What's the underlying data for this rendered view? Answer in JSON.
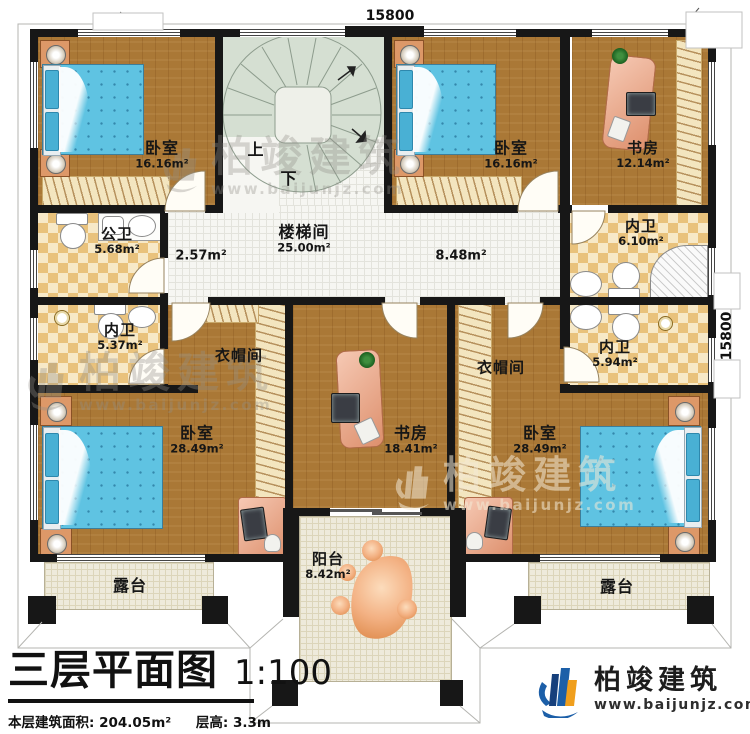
{
  "dimensions": {
    "top": "15800",
    "right": "15800"
  },
  "stair": {
    "up": "上",
    "down": "下"
  },
  "rooms": {
    "bedroom_tl": {
      "name": "卧室",
      "area": "16.16m²"
    },
    "bedroom_tr": {
      "name": "卧室",
      "area": "16.16m²"
    },
    "study_tr": {
      "name": "书房",
      "area": "12.14m²"
    },
    "public_bath": {
      "name": "公卫",
      "area": "5.68m²"
    },
    "hall_left": {
      "area": "2.57m²"
    },
    "stairwell": {
      "name": "楼梯间",
      "area": "25.00m²"
    },
    "hall_right": {
      "area": "8.48m²"
    },
    "inner_bath_tr": {
      "name": "内卫",
      "area": "6.10m²"
    },
    "inner_bath_l": {
      "name": "内卫",
      "area": "5.37m²"
    },
    "inner_bath_r": {
      "name": "内卫",
      "area": "5.94m²"
    },
    "cloak_left": {
      "name": "衣帽间"
    },
    "cloak_right": {
      "name": "衣帽间"
    },
    "study_bottom": {
      "name": "书房",
      "area": "18.41m²"
    },
    "bedroom_bl": {
      "name": "卧室",
      "area": "28.49m²"
    },
    "bedroom_br": {
      "name": "卧室",
      "area": "28.49m²"
    },
    "balcony": {
      "name": "阳台",
      "area": "8.42m²"
    },
    "terrace_left": {
      "name": "露台"
    },
    "terrace_right": {
      "name": "露台"
    }
  },
  "title_block": {
    "title": "三层平面图",
    "scale": "1:100",
    "area_line": "本层建筑面积: 204.05m²",
    "floor_height": "层高: 3.3m"
  },
  "brand": {
    "name": "柏竣建筑",
    "url": "www.baijunjz.com"
  },
  "watermark": {
    "name": "柏竣建筑",
    "url": "www.baijunjz.com"
  },
  "colors": {
    "wall": "#171717",
    "wood": "#aa7836",
    "bath_check": "#e9c27c",
    "bath_bg": "#f7e9c8",
    "tile": "#f6f6f2",
    "stair": "#d5dfd2",
    "terrace": "#eeeadb",
    "bed_blue": "#5fc3e2",
    "desk_pink": "#eda98e",
    "brand_blue": "#1c5fa8",
    "brand_orange": "#f09f1d"
  }
}
